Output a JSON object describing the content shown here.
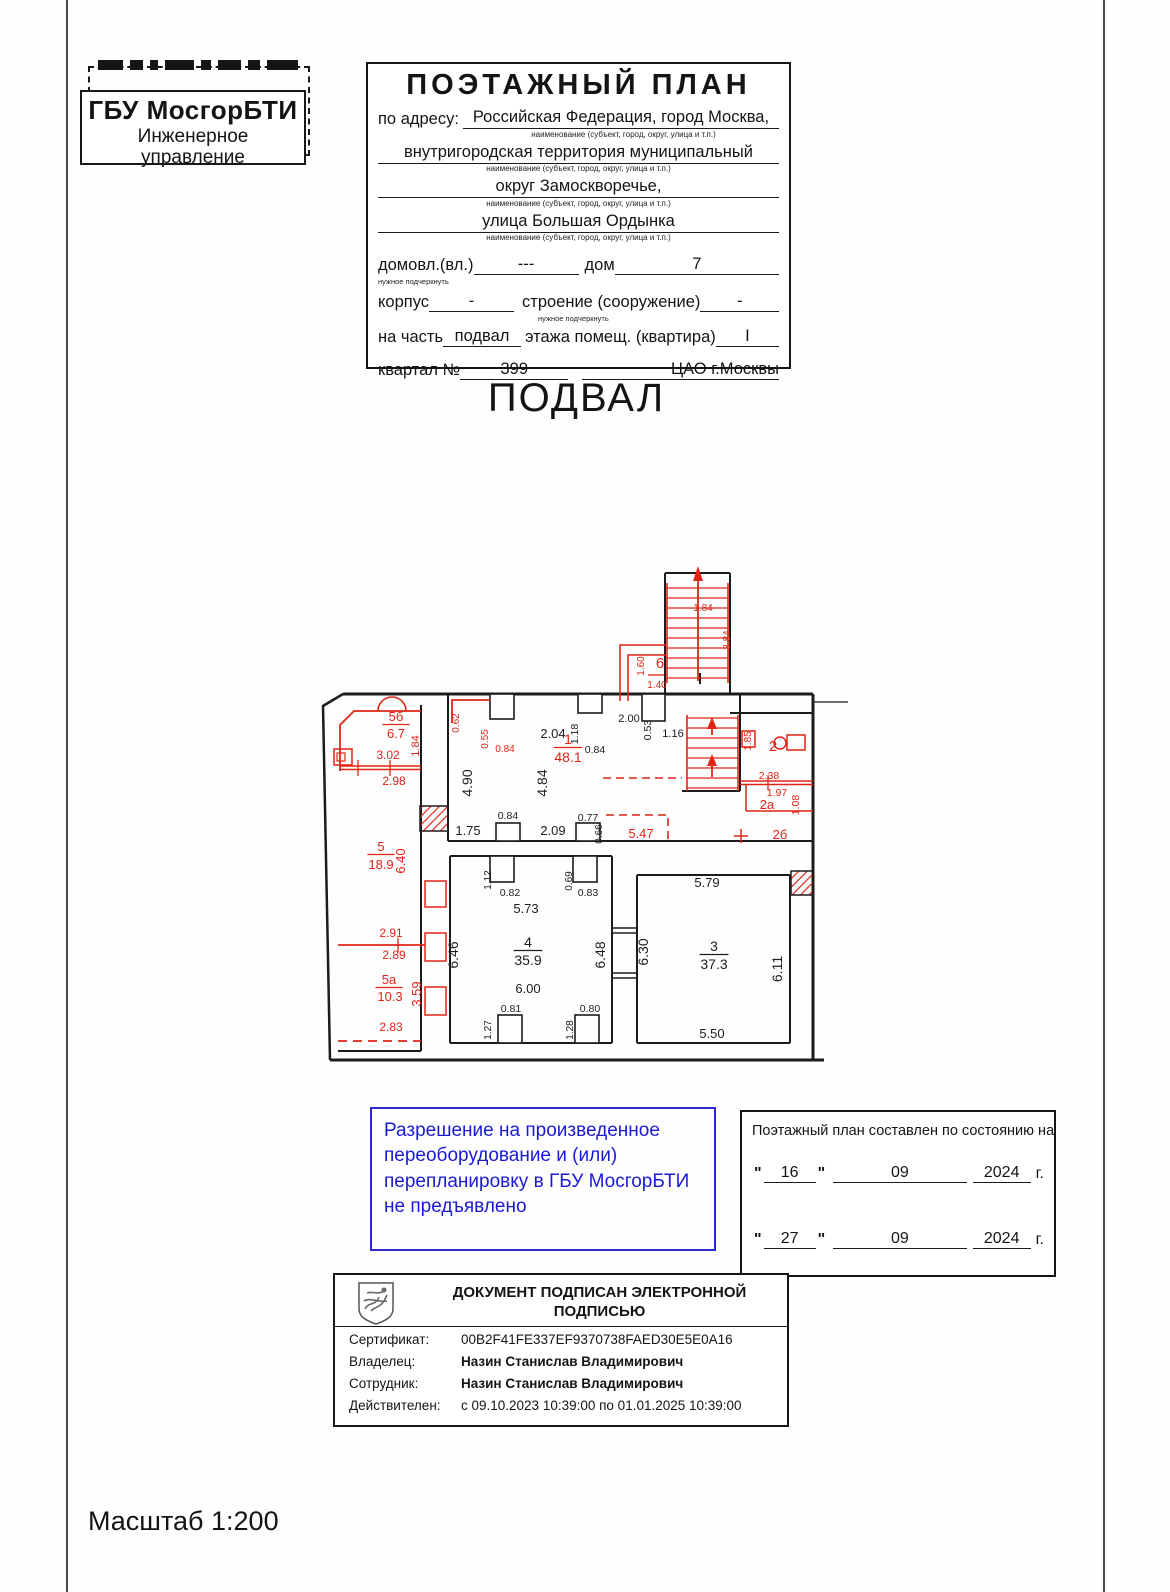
{
  "stamp": {
    "org": "ГБУ МосгорБТИ",
    "dept1": "Инженерное",
    "dept2": "управление"
  },
  "header": {
    "title": "ПОЭТАЖНЫЙ ПЛАН",
    "address_label": "по адресу:",
    "address_lines": [
      "Российская Федерация, город Москва,",
      "внутригородская территория муниципальный",
      "округ Замоскворечье,",
      "улица Большая Ордынка"
    ],
    "caption": "наименование (субъект, город, округ, улица и т.п.)",
    "underline_note": "нужное подчеркнуть",
    "domovl_label": "домовл.(вл.)",
    "domovl_value": "---",
    "dom_label": "дом",
    "dom_value": "7",
    "korpus_label": "корпус",
    "korpus_value": "-",
    "stroenie_label": "строение (сооружение)",
    "stroenie_value": "-",
    "nachast_label": "на часть",
    "nachast_value": "подвал",
    "etazh_label": "этажа помещ. (квартира)",
    "kvartira_value": "I",
    "kvartal_label": "квартал №",
    "kvartal_value": "399",
    "district": "ЦАО г.Москвы"
  },
  "floor_title": "ПОДВАЛ",
  "plan": {
    "red": "#e02417",
    "black": "#1c1c1c",
    "labels": [
      {
        "t": "2.04",
        "x": 243,
        "y": 185,
        "c": "k",
        "fs": 13
      },
      {
        "t": "1.18",
        "x": 268,
        "y": 181,
        "c": "k",
        "fs": 10.5,
        "r": 1
      },
      {
        "t": "0.84",
        "x": 285,
        "y": 200,
        "c": "k",
        "fs": 10.5
      },
      {
        "t": "2.00",
        "x": 319,
        "y": 169,
        "c": "k",
        "fs": 11
      },
      {
        "t": "0.53",
        "x": 341,
        "y": 177,
        "c": "k",
        "fs": 10.5,
        "r": 1
      },
      {
        "t": "1.16",
        "x": 363,
        "y": 184,
        "c": "k",
        "fs": 11
      },
      {
        "t": "4.90",
        "x": 162,
        "y": 230,
        "c": "k",
        "fs": 14,
        "r": 1
      },
      {
        "t": "4.84",
        "x": 237,
        "y": 230,
        "c": "k",
        "fs": 14,
        "r": 1
      },
      {
        "t": "1.75",
        "x": 158,
        "y": 282,
        "c": "k",
        "fs": 13
      },
      {
        "t": "0.84",
        "x": 198,
        "y": 266,
        "c": "k",
        "fs": 10.5
      },
      {
        "t": "2.09",
        "x": 243,
        "y": 282,
        "c": "k",
        "fs": 13
      },
      {
        "t": "0.77",
        "x": 278,
        "y": 268,
        "c": "k",
        "fs": 10.5
      },
      {
        "t": "0.66",
        "x": 292,
        "y": 281,
        "c": "k",
        "fs": 10,
        "r": 1
      },
      {
        "t": "5.73",
        "x": 216,
        "y": 360,
        "c": "k",
        "fs": 13
      },
      {
        "t": "0.82",
        "x": 200,
        "y": 343,
        "c": "k",
        "fs": 10.5
      },
      {
        "t": "1.12",
        "x": 181,
        "y": 327,
        "c": "k",
        "fs": 10,
        "r": 1
      },
      {
        "t": "0.69",
        "x": 262,
        "y": 328,
        "c": "k",
        "fs": 10,
        "r": 1
      },
      {
        "t": "0.83",
        "x": 278,
        "y": 343,
        "c": "k",
        "fs": 10.5
      },
      {
        "t": "4",
        "x": 218,
        "y": 394,
        "c": "k",
        "fs": 14,
        "u": 1
      },
      {
        "t": "35.9",
        "x": 218,
        "y": 412,
        "c": "k",
        "fs": 14
      },
      {
        "t": "6.00",
        "x": 218,
        "y": 440,
        "c": "k",
        "fs": 13
      },
      {
        "t": "6.46",
        "x": 148,
        "y": 402,
        "c": "k",
        "fs": 14,
        "r": 1
      },
      {
        "t": "6.48",
        "x": 295,
        "y": 402,
        "c": "k",
        "fs": 14,
        "r": 1
      },
      {
        "t": "0.81",
        "x": 201,
        "y": 459,
        "c": "k",
        "fs": 10.5
      },
      {
        "t": "1.27",
        "x": 181,
        "y": 477,
        "c": "k",
        "fs": 10,
        "r": 1
      },
      {
        "t": "0.80",
        "x": 280,
        "y": 459,
        "c": "k",
        "fs": 10.5
      },
      {
        "t": "1.28",
        "x": 263,
        "y": 477,
        "c": "k",
        "fs": 10,
        "r": 1
      },
      {
        "t": "5.79",
        "x": 397,
        "y": 334,
        "c": "k",
        "fs": 13
      },
      {
        "t": "6.30",
        "x": 338,
        "y": 399,
        "c": "k",
        "fs": 14,
        "r": 1
      },
      {
        "t": "3",
        "x": 404,
        "y": 398,
        "c": "k",
        "fs": 14,
        "u": 1
      },
      {
        "t": "37.3",
        "x": 404,
        "y": 416,
        "c": "k",
        "fs": 14
      },
      {
        "t": "6.11",
        "x": 472,
        "y": 416,
        "c": "k",
        "fs": 14,
        "r": 1
      },
      {
        "t": "5.50",
        "x": 402,
        "y": 485,
        "c": "k",
        "fs": 13
      },
      {
        "t": "5б",
        "x": 86,
        "y": 168,
        "c": "r",
        "fs": 13,
        "u": 1
      },
      {
        "t": "6.7",
        "x": 86,
        "y": 185,
        "c": "r",
        "fs": 13
      },
      {
        "t": "3.02",
        "x": 78,
        "y": 206,
        "c": "r",
        "fs": 12
      },
      {
        "t": "2.98",
        "x": 84,
        "y": 232,
        "c": "r",
        "fs": 12
      },
      {
        "t": "1.84",
        "x": 109,
        "y": 193,
        "c": "r",
        "fs": 11,
        "r": 1
      },
      {
        "t": "0.62",
        "x": 149,
        "y": 170,
        "c": "r",
        "fs": 10,
        "r": 1
      },
      {
        "t": "0.55",
        "x": 178,
        "y": 186,
        "c": "r",
        "fs": 10,
        "r": 1
      },
      {
        "t": "0.84",
        "x": 195,
        "y": 199,
        "c": "r",
        "fs": 10
      },
      {
        "t": "1",
        "x": 258,
        "y": 191,
        "c": "r",
        "fs": 14,
        "u": 1
      },
      {
        "t": "48.1",
        "x": 258,
        "y": 209,
        "c": "r",
        "fs": 14
      },
      {
        "t": "5.47",
        "x": 331,
        "y": 285,
        "c": "r",
        "fs": 13
      },
      {
        "t": "5",
        "x": 71,
        "y": 298,
        "c": "r",
        "fs": 13,
        "u": 1
      },
      {
        "t": "18.9",
        "x": 71,
        "y": 316,
        "c": "r",
        "fs": 13
      },
      {
        "t": "6.40",
        "x": 95,
        "y": 308,
        "c": "r",
        "fs": 13,
        "r": 1
      },
      {
        "t": "2.91",
        "x": 81,
        "y": 384,
        "c": "r",
        "fs": 12
      },
      {
        "t": "2.89",
        "x": 84,
        "y": 406,
        "c": "r",
        "fs": 12
      },
      {
        "t": "5а",
        "x": 79,
        "y": 431,
        "c": "r",
        "fs": 13,
        "u": 1
      },
      {
        "t": "10.3",
        "x": 80,
        "y": 448,
        "c": "r",
        "fs": 13
      },
      {
        "t": "3.59",
        "x": 111,
        "y": 441,
        "c": "r",
        "fs": 13,
        "r": 1
      },
      {
        "t": "2.83",
        "x": 81,
        "y": 478,
        "c": "r",
        "fs": 12
      },
      {
        "t": "6",
        "x": 350,
        "y": 115,
        "c": "r",
        "fs": 15
      },
      {
        "t": "1.60",
        "x": 334,
        "y": 113,
        "c": "r",
        "fs": 10,
        "r": 1
      },
      {
        "t": "1.40",
        "x": 347,
        "y": 135,
        "c": "r",
        "fs": 10
      },
      {
        "t": "1.84",
        "x": 393,
        "y": 58,
        "c": "r",
        "fs": 10
      },
      {
        "t": "3.84",
        "x": 420,
        "y": 87,
        "c": "r",
        "fs": 10,
        "r": 1
      },
      {
        "t": "2",
        "x": 463,
        "y": 198,
        "c": "r",
        "fs": 15
      },
      {
        "t": "1.85",
        "x": 441,
        "y": 188,
        "c": "r",
        "fs": 10,
        "r": 1
      },
      {
        "t": "2.38",
        "x": 459,
        "y": 226,
        "c": "r",
        "fs": 10.5
      },
      {
        "t": "1.97",
        "x": 467,
        "y": 243,
        "c": "r",
        "fs": 10.5
      },
      {
        "t": "1.08",
        "x": 489,
        "y": 252,
        "c": "r",
        "fs": 10.5,
        "r": 1
      },
      {
        "t": "2а",
        "x": 457,
        "y": 256,
        "c": "r",
        "fs": 13
      },
      {
        "t": "2б",
        "x": 470,
        "y": 286,
        "c": "r",
        "fs": 13
      }
    ]
  },
  "permission_note": {
    "lines": [
      "Разрешение на произведенное",
      "переоборудование и (или)",
      "перепланировку в ГБУ МосгорБТИ",
      "не предъявлено"
    ]
  },
  "status_box": {
    "title": "Поэтажный план составлен по состоянию на",
    "quote": "\"",
    "year_suffix": "г.",
    "dates": [
      {
        "day": "16",
        "month": "09",
        "year": "2024"
      },
      {
        "day": "27",
        "month": "09",
        "year": "2024"
      }
    ]
  },
  "signature": {
    "title1": "ДОКУМЕНТ ПОДПИСАН ЭЛЕКТРОННОЙ",
    "title2": "ПОДПИСЬЮ",
    "rows": [
      {
        "label": "Сертификат:",
        "value": "00B2F41FE337EF9370738FAED30E5E0A16",
        "bold": false
      },
      {
        "label": "Владелец:",
        "value": "Назин Станислав Владимирович",
        "bold": true
      },
      {
        "label": "Сотрудник:",
        "value": "Назин Станислав Владимирович",
        "bold": true
      },
      {
        "label": "Действителен:",
        "value": "с 09.10.2023 10:39:00 по 01.01.2025 10:39:00",
        "bold": false
      }
    ]
  },
  "scale_label": "Масштаб 1:200"
}
